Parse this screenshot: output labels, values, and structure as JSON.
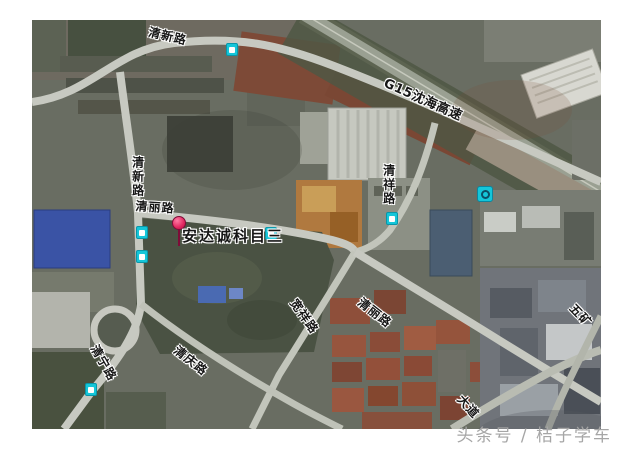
{
  "map": {
    "type": "satellite",
    "marker": {
      "label": "安达诚科目三",
      "pin_color": "#e0275f"
    },
    "road_labels": [
      {
        "text": "清新路",
        "orientation": "curved-horizontal",
        "position": "top"
      },
      {
        "text": "G15沈海高速",
        "orientation": "diagonal",
        "position": "top-right",
        "type": "highway"
      },
      {
        "text": "清新路",
        "orientation": "vertical",
        "position": "left"
      },
      {
        "text": "清丽路",
        "orientation": "horizontal",
        "position": "center-left"
      },
      {
        "text": "清祥路",
        "orientation": "vertical",
        "position": "center-right"
      },
      {
        "text": "清丽路",
        "orientation": "diagonal",
        "position": "center"
      },
      {
        "text": "宽祥路",
        "orientation": "diagonal",
        "position": "center-south"
      },
      {
        "text": "清庆路",
        "orientation": "diagonal",
        "position": "bottom-left"
      },
      {
        "text": "清宁路",
        "orientation": "diagonal",
        "position": "bottom-left-edge"
      },
      {
        "text": "五矿",
        "orientation": "diagonal",
        "position": "right-edge",
        "partial": true
      },
      {
        "text": "大道",
        "orientation": "diagonal",
        "position": "bottom",
        "partial": true
      }
    ],
    "transit_icons": [
      {
        "kind": "bus-stop",
        "near": "清新路 top"
      },
      {
        "kind": "bus-stop",
        "near": "清新路 left upper"
      },
      {
        "kind": "bus-stop",
        "near": "清新路 left lower"
      },
      {
        "kind": "bus-stop",
        "near": "清祥路"
      },
      {
        "kind": "bus-stop",
        "near": "安达诚科目三"
      },
      {
        "kind": "bus-stop",
        "near": "清宁路"
      },
      {
        "kind": "metro-station",
        "near": "清祥路 north"
      }
    ],
    "icon_color": "#14c6d9"
  },
  "watermark": {
    "text": "头条号 / 桔子学车",
    "color": "#a6a6a6"
  }
}
